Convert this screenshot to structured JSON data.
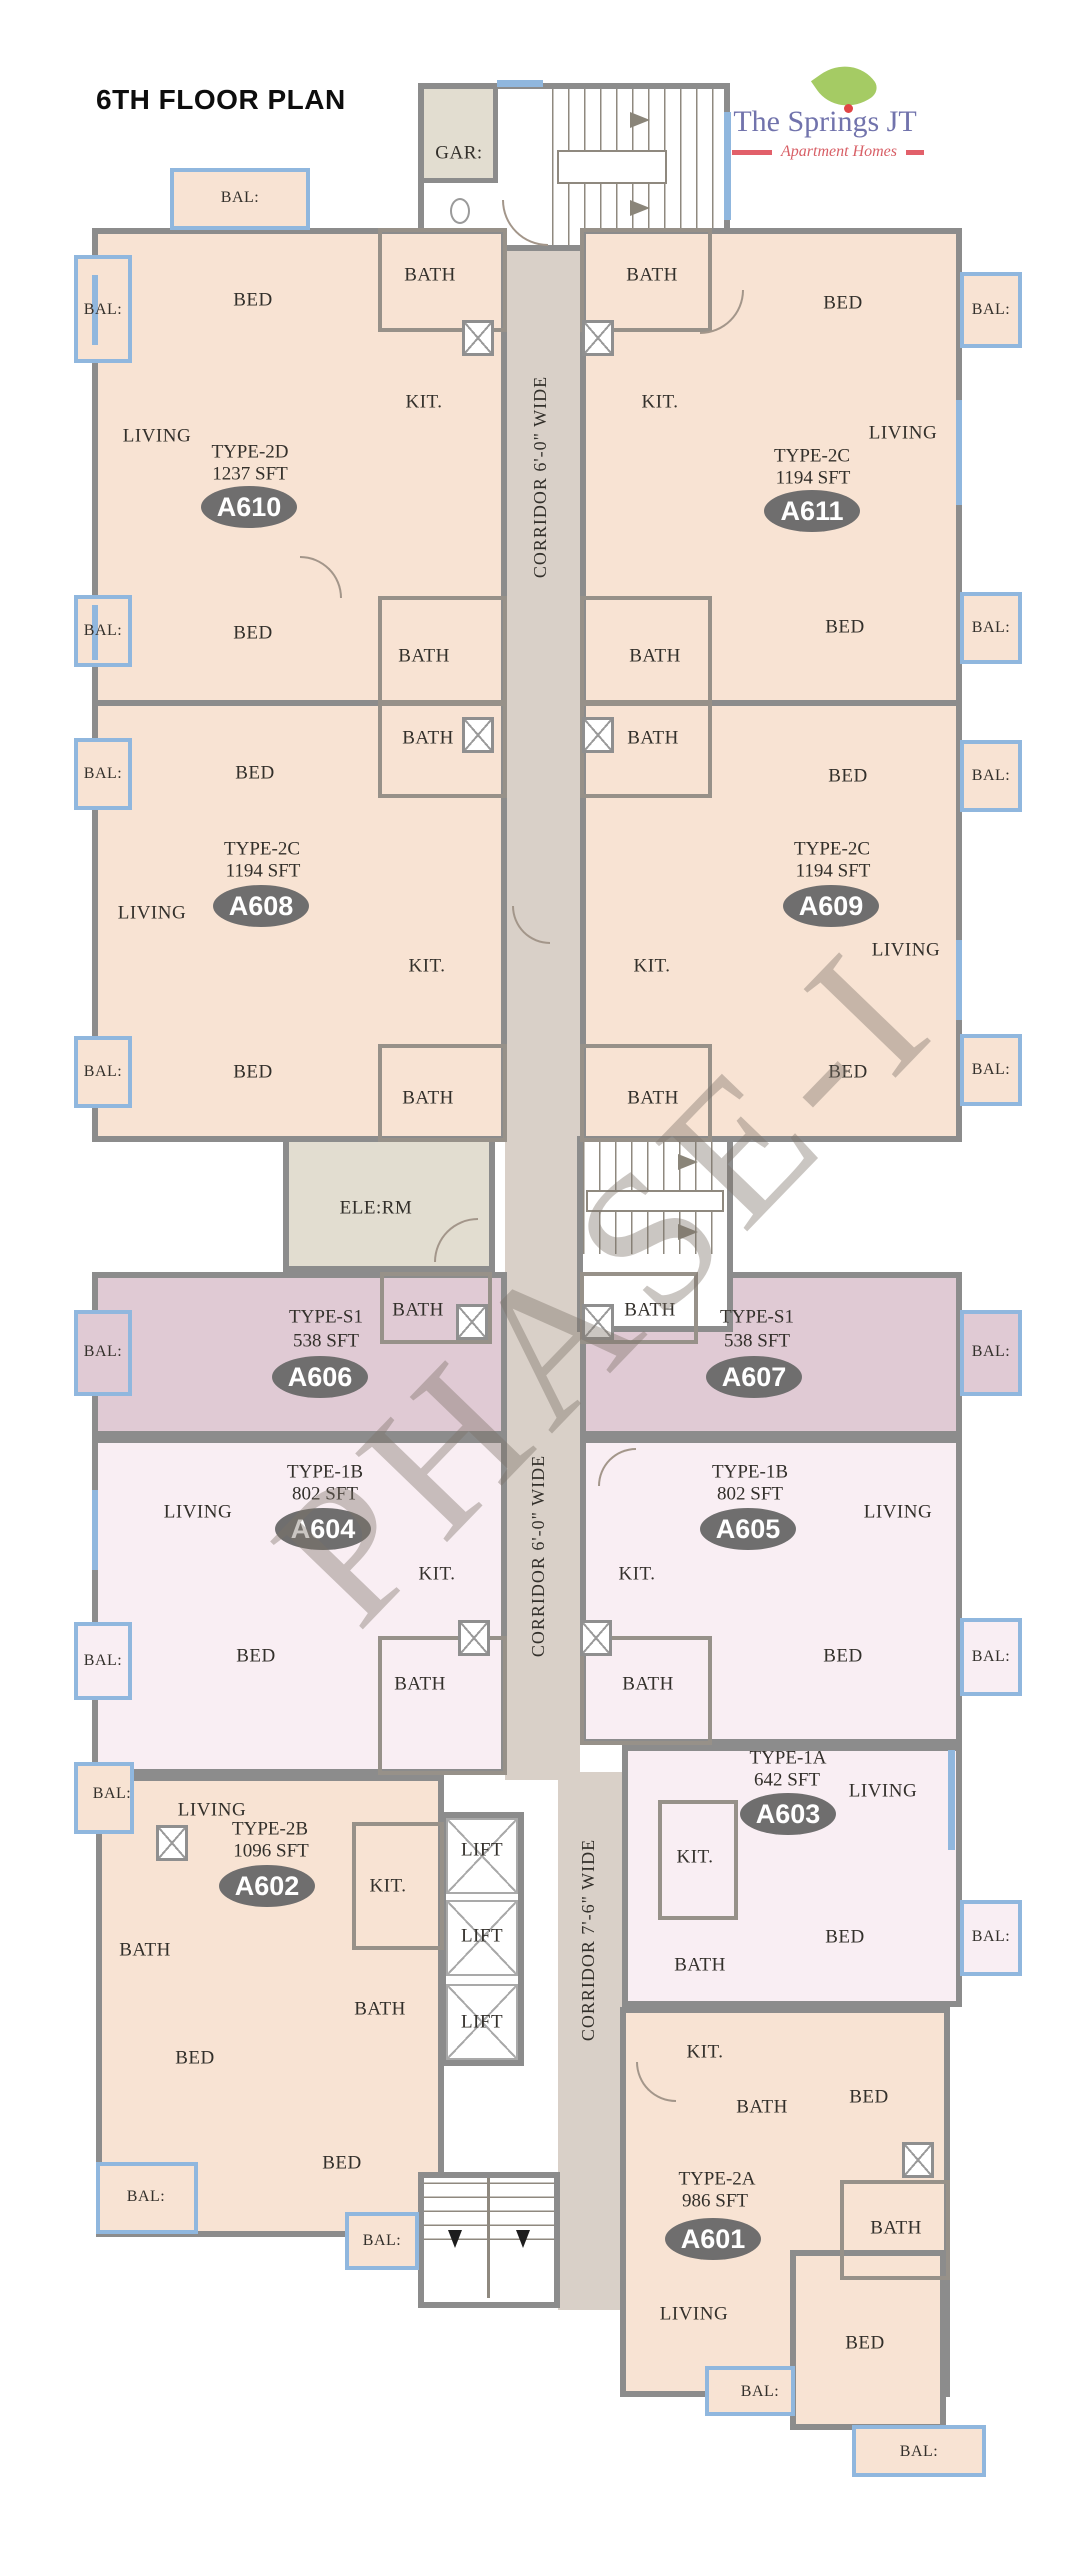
{
  "title": "6TH FLOOR PLAN",
  "logo": {
    "name": "The Springs JT",
    "tagline": "Apartment Homes"
  },
  "watermark": "PHASE-I",
  "corridors": [
    "CORRIDOR 6'-0\" WIDE",
    "CORRIDOR 6'-0\" WIDE",
    "CORRIDOR 7'-6\" WIDE"
  ],
  "room_labels": {
    "bed": "BED",
    "living": "LIVING",
    "kitchen": "KIT.",
    "bath": "BATH",
    "balcony": "BAL:",
    "gar": "GAR:",
    "ele_rm": "ELE:RM",
    "lift": "LIFT"
  },
  "units": [
    {
      "id": "A610",
      "type": "TYPE-2D",
      "area": "1237 SFT"
    },
    {
      "id": "A611",
      "type": "TYPE-2C",
      "area": "1194 SFT"
    },
    {
      "id": "A608",
      "type": "TYPE-2C",
      "area": "1194 SFT"
    },
    {
      "id": "A609",
      "type": "TYPE-2C",
      "area": "1194 SFT"
    },
    {
      "id": "A606",
      "type": "TYPE-S1",
      "area": "538 SFT"
    },
    {
      "id": "A607",
      "type": "TYPE-S1",
      "area": "538 SFT"
    },
    {
      "id": "A604",
      "type": "TYPE-1B",
      "area": "802 SFT"
    },
    {
      "id": "A605",
      "type": "TYPE-1B",
      "area": "802 SFT"
    },
    {
      "id": "A603",
      "type": "TYPE-1A",
      "area": "642 SFT"
    },
    {
      "id": "A602",
      "type": "TYPE-2B",
      "area": "1096 SFT"
    },
    {
      "id": "A601",
      "type": "TYPE-2A",
      "area": "986 SFT"
    }
  ],
  "colors": {
    "unit_peach": "#f8e3d3",
    "unit_studio_mauve": "#e0cad4",
    "unit_1bhk_pink": "#f9eef3",
    "corridor_tan": "#d9d0c8",
    "utility_beige": "#e2ddd0",
    "wall_gray": "#8c8c8c",
    "window_blue": "#90b7de",
    "badge_gray": "#6f6e6e",
    "logo_purple": "#7173ac",
    "logo_red": "#e2606a",
    "leaf_green": "#a5cb64"
  }
}
